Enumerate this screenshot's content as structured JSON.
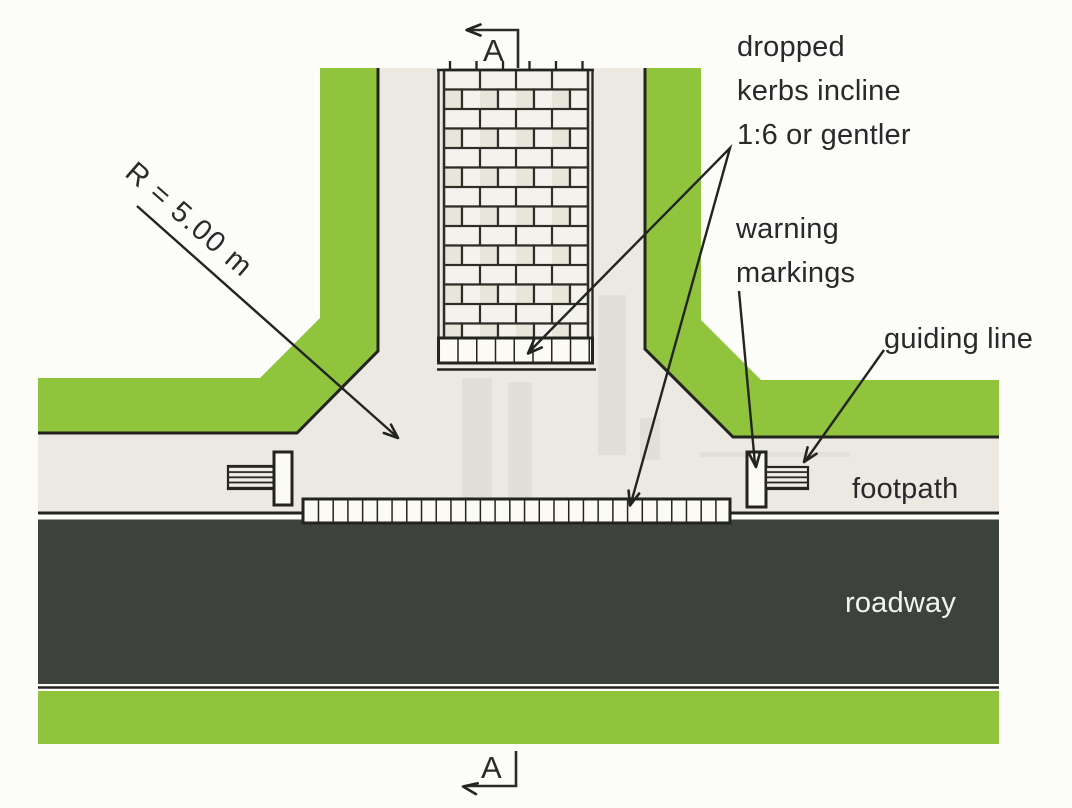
{
  "labels": {
    "dropped_kerbs": "dropped\nkerbs incline\n1:6 or gentler",
    "warning_markings": "warning\nmarkings",
    "guiding_line": "guiding line",
    "footpath": "footpath",
    "roadway": "roadway",
    "radius": "R = 5.00 m"
  },
  "section_markers": {
    "top": "A",
    "bottom": "A"
  },
  "colors": {
    "verge_green": "#8fc43c",
    "footpath_grey": "#ebe9e1",
    "roadway_dark": "#3e423e",
    "outline_dark": "#232420",
    "marking_white": "#fbfaf5",
    "brick_light": "#f3f1ea",
    "page_background": "#fcfcf9",
    "label_text": "#29292b",
    "roadway_label_text": "#f4f4f1"
  }
}
